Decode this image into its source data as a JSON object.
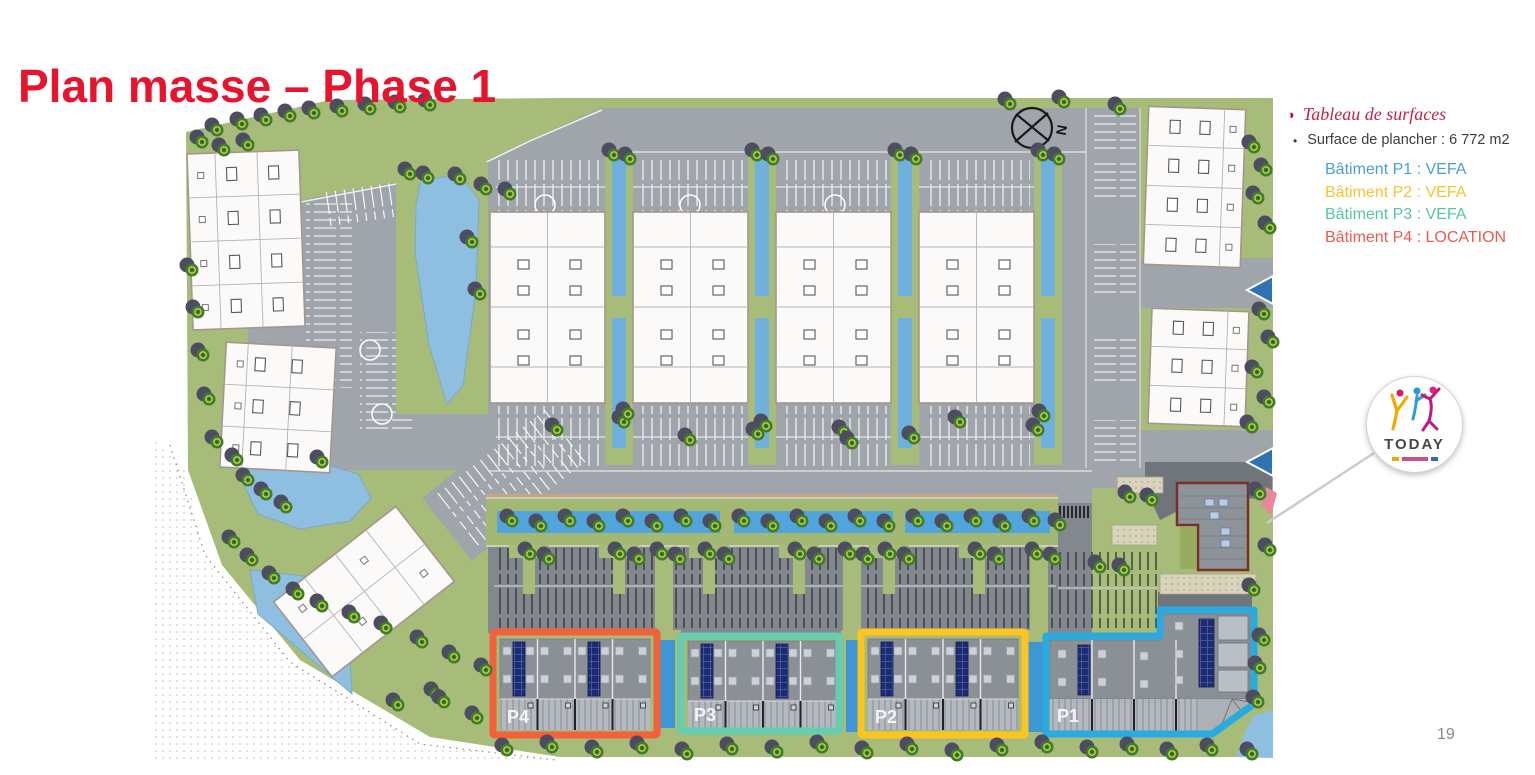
{
  "slide": {
    "title": "Plan masse – Phase 1",
    "page_number": "19"
  },
  "icons": {
    "legend_arrow": "◗",
    "bullet": "•"
  },
  "legend": {
    "heading": "Tableau de surfaces",
    "surface_line": "Surface de plancher : 6 772 m2",
    "buildings": [
      {
        "label": "Bâtiment P1 : VEFA",
        "color": "#4A9FD4"
      },
      {
        "label": "Bâtiment P2 : VEFA",
        "color": "#F8C331"
      },
      {
        "label": "Bâtiment P3 : VEFA",
        "color": "#57C6A2"
      },
      {
        "label": "Bâtiment P4 : LOCATION",
        "color": "#EA5B4F"
      }
    ]
  },
  "map": {
    "compass_label": "N",
    "logo_text": "TODAY",
    "building_labels": [
      {
        "id": "p4",
        "text": "P4",
        "outline_color": "#F2603C"
      },
      {
        "id": "p3",
        "text": "P3",
        "outline_color": "#66CDB1"
      },
      {
        "id": "p2",
        "text": "P2",
        "outline_color": "#FFC421"
      },
      {
        "id": "p1",
        "text": "P1",
        "outline_color": "#29ABE2"
      }
    ]
  },
  "colors": {
    "title_red": "#E8132D",
    "grass": "#A6BC78",
    "road": "#9FA5AA",
    "water": "#8FBFE0"
  }
}
